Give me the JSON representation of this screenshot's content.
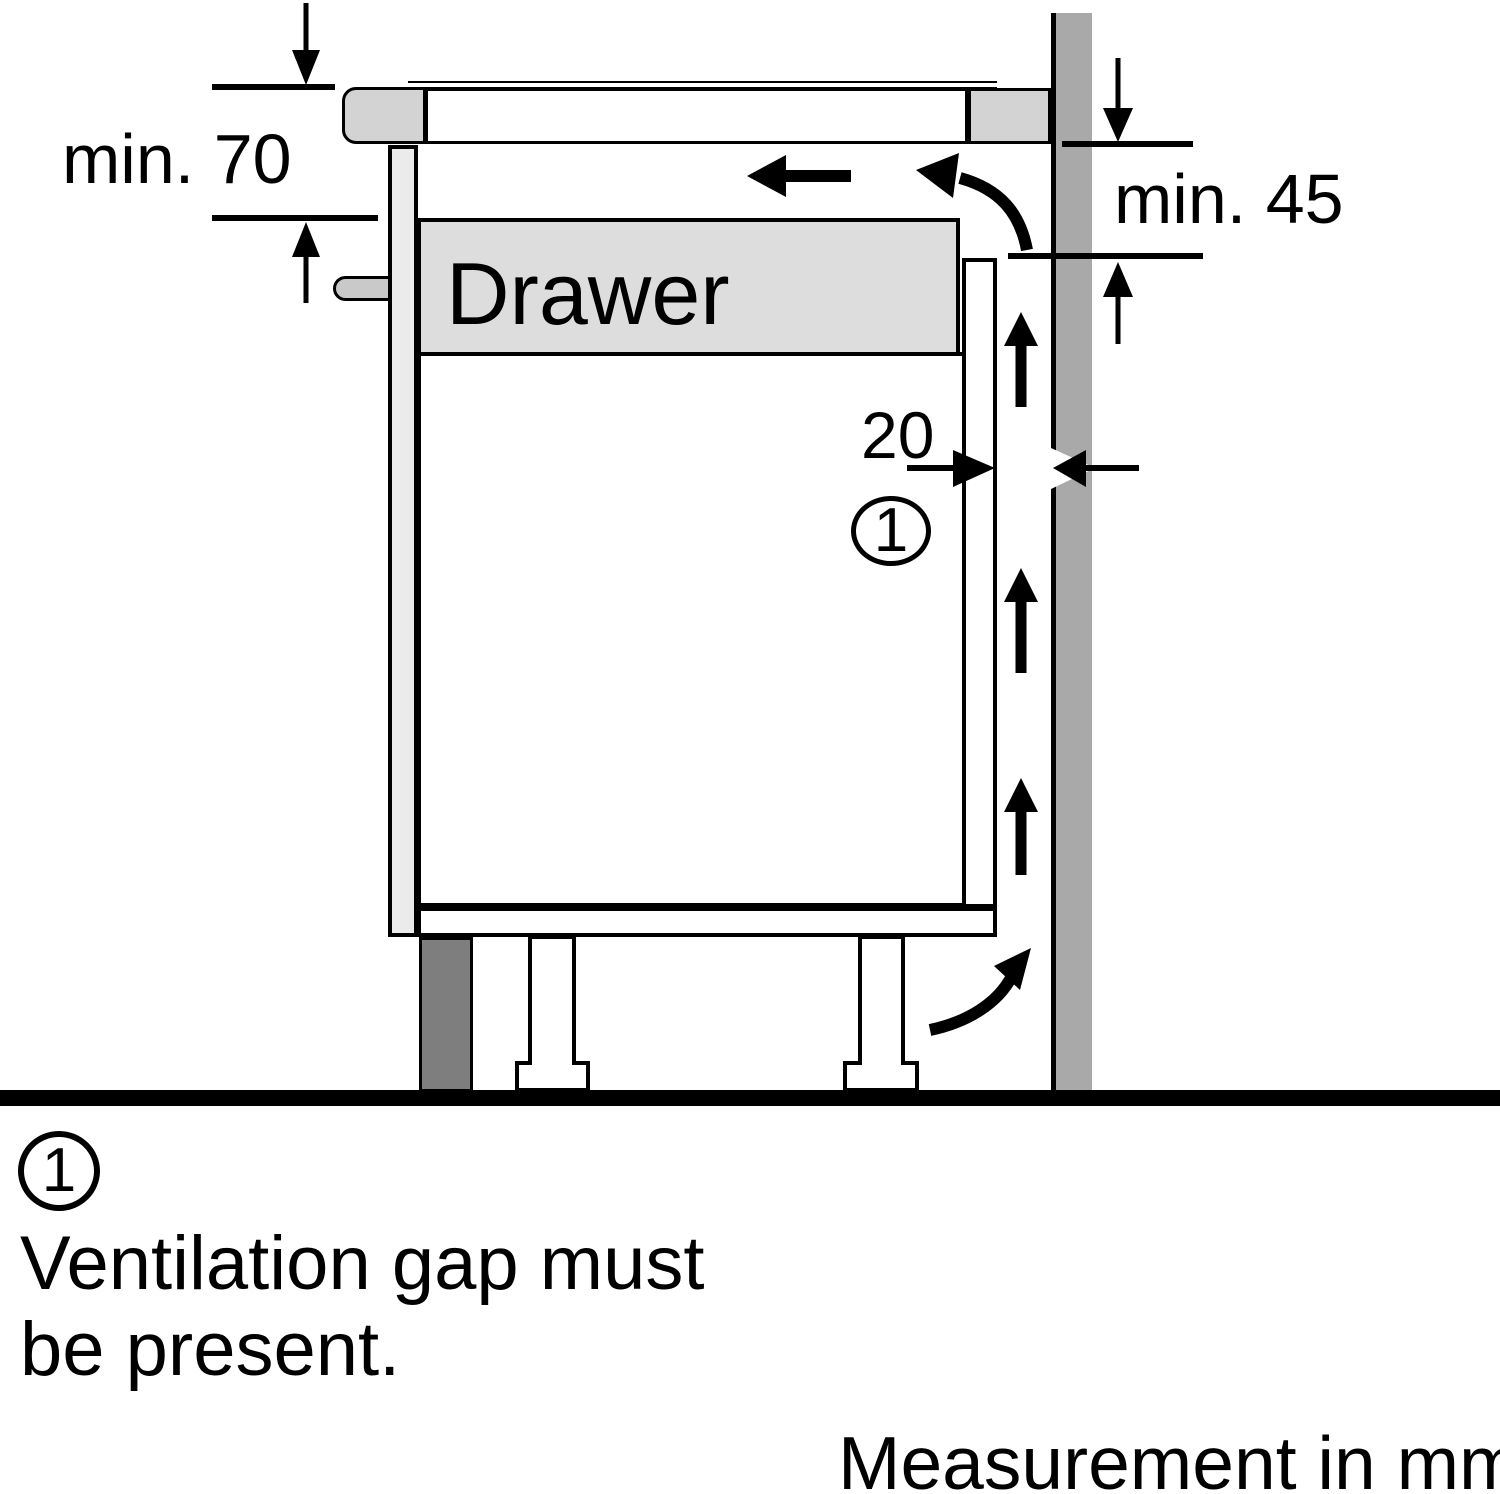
{
  "labels": {
    "min_top": "min. 70",
    "min_right": "min. 45",
    "gap": "20",
    "drawer": "Drawer",
    "callout": "1"
  },
  "footnote": {
    "marker": "1",
    "line1": "Ventilation gap must",
    "line2": "be present."
  },
  "footer": {
    "units": "Measurement in mm"
  },
  "colors": {
    "wall": "#a9a9a9",
    "trim": "#d3d3d3",
    "drawer": "#dddddd",
    "panel": "#ebebeb",
    "plinth": "#7e7e7e",
    "handle": "#c9c9c9",
    "line": "#000000"
  }
}
